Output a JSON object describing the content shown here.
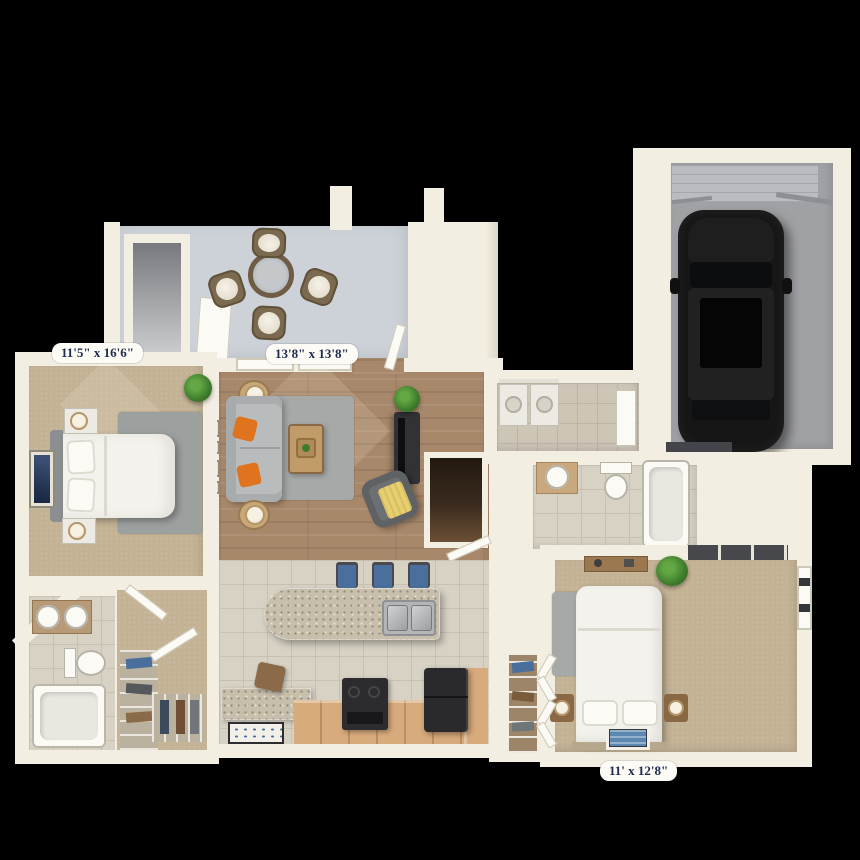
{
  "scene": {
    "type": "3d-apartment-floor-plan",
    "description": "Top-down 3D rendering of a two bedroom, two bath apartment with patio and attached one-car garage on a black background",
    "background": "#000000"
  },
  "dimension_labels": [
    {
      "room": "bedroom-1",
      "text": "11'5\" x 16'6\""
    },
    {
      "room": "living-room",
      "text": "13'8\" x 13'8\""
    },
    {
      "room": "bedroom-2",
      "text": "11' x 12'8\""
    }
  ],
  "rooms": [
    {
      "name": "patio",
      "contents": [
        "storage-closet",
        "outdoor-round-table",
        "4 rattan chairs"
      ]
    },
    {
      "name": "bedroom-1",
      "dimensions": "11'5\" x 16'6\"",
      "contents": [
        "bed",
        "2 nightstands with lamps",
        "rug",
        "wall-art",
        "plant",
        "window"
      ]
    },
    {
      "name": "living-room",
      "dimensions": "13'8\" x 13'8\"",
      "contents": [
        "sofa with orange pillows",
        "2 side tables with lamps",
        "coffee-table",
        "rug",
        "tv-console",
        "armchair with yellow throw",
        "plant",
        "windows"
      ]
    },
    {
      "name": "kitchen",
      "contents": [
        "granite island with double sink",
        "3 bar stools",
        "range",
        "refrigerator",
        "microwave",
        "half-wall",
        "floor-mat"
      ]
    },
    {
      "name": "laundry-room",
      "contents": [
        "washer",
        "dryer",
        "door-to-garage"
      ]
    },
    {
      "name": "bathroom-1",
      "contents": [
        "double vanity",
        "toilet",
        "bathtub"
      ]
    },
    {
      "name": "walk-in-closet",
      "contents": [
        "clothes shelving"
      ]
    },
    {
      "name": "bathroom-2",
      "contents": [
        "vanity sink",
        "toilet",
        "bathtub"
      ]
    },
    {
      "name": "bedroom-2",
      "dimensions": "11' x 12'8\"",
      "contents": [
        "bed",
        "2 nightstands with lamps",
        "dresser",
        "rug",
        "bifold closet",
        "pantry shelving",
        "plant",
        "window",
        "floor-mat"
      ]
    },
    {
      "name": "garage",
      "contents": [
        "car",
        "garage-door"
      ]
    }
  ],
  "colors": {
    "wall": "#f2eee1",
    "wood_floor": "#a8886b",
    "carpet": "#c3b294",
    "tile": "#d8d2c5",
    "patio_concrete": "#cdd2d8",
    "garage_floor": "#a0a1a5",
    "car_body": "#161616",
    "granite": "#c7beac",
    "cabinet_tan": "#d8ab7c",
    "accent_orange": "#e0731d",
    "accent_yellow": "#e7cf6e",
    "rug_gray": "#a6a9a7",
    "label_text": "#1d2b50",
    "label_bg": "#fcfbf6"
  }
}
